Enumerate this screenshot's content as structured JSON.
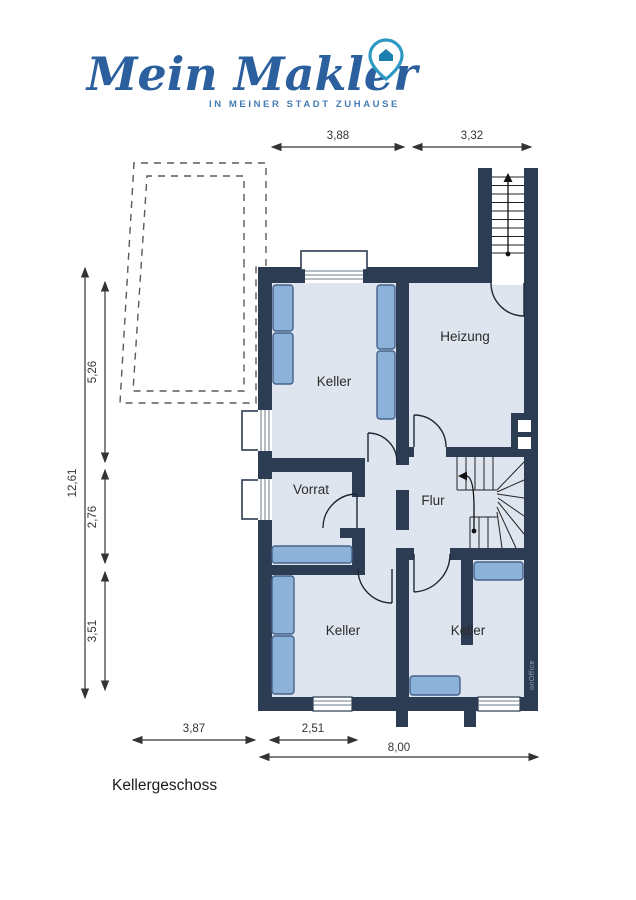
{
  "logo": {
    "brand": "Mein Makler",
    "tagline": "IN MEINER STADT ZUHAUSE",
    "brand_color": "#2b5f9e",
    "tagline_color": "#447cb4",
    "pin_color": "#2e9ac4"
  },
  "plan": {
    "floor_title": "Kellergeschoss",
    "watermark": "onOffice",
    "rooms": {
      "keller_top": "Keller",
      "heizung": "Heizung",
      "vorrat": "Vorrat",
      "flur": "Flur",
      "keller_bottom_left": "Keller",
      "keller_bottom_right": "Keller"
    },
    "dimensions": {
      "top_left": "3,88",
      "top_right": "3,32",
      "left_total": "12,61",
      "left_upper": "5,26",
      "left_middle": "2,76",
      "left_lower": "3,51",
      "bottom_left": "3,87",
      "bottom_middle": "2,51",
      "bottom_total": "8,00"
    },
    "colors": {
      "wall": "#2c3c52",
      "room_fill": "#dfe5ee",
      "furniture": "#8db2d9",
      "dimension_text": "#333333"
    }
  }
}
